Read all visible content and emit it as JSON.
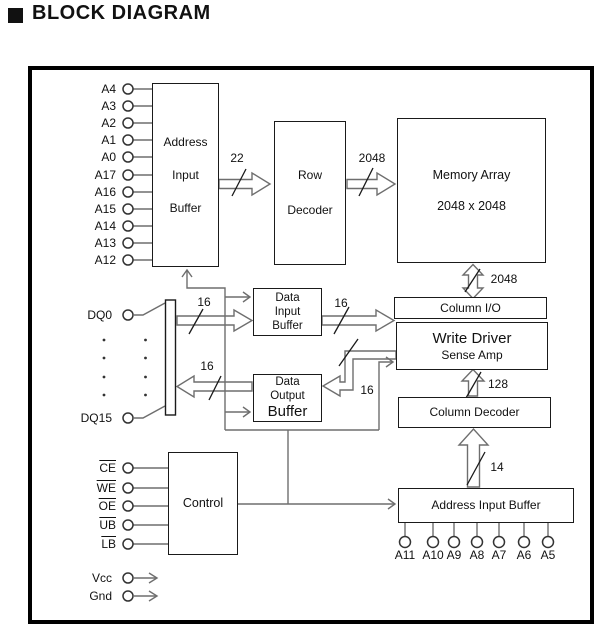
{
  "title": "BLOCK DIAGRAM",
  "blocks": {
    "address_input_buffer_top": {
      "line1": "Address",
      "line2": "Input",
      "line3": "Buffer"
    },
    "row_decoder": {
      "line1": "Row",
      "line2": "Decoder"
    },
    "memory_array": {
      "line1": "Memory Array",
      "line2": "2048 x 2048"
    },
    "column_io": {
      "label": "Column I/O"
    },
    "write_driver": {
      "line1": "Write Driver",
      "line2": "Sense Amp"
    },
    "column_decoder": {
      "label": "Column Decoder"
    },
    "data_input_buffer": {
      "line1": "Data",
      "line2": "Input",
      "line3": "Buffer"
    },
    "data_output_buffer": {
      "line1": "Data",
      "line2": "Output",
      "line3": "Buffer"
    },
    "control": {
      "label": "Control"
    },
    "address_input_buffer_bottom": {
      "label": "Address Input Buffer"
    }
  },
  "buses": {
    "addr_to_row_decoder": "22",
    "row_decoder_to_memory": "2048",
    "memory_to_column_io": "2048",
    "dq_to_data_input": "16",
    "data_input_to_write_driver": "16",
    "write_driver_to_data_output": "16",
    "data_output_to_dq": "16",
    "column_decoder_to_write_driver": "128",
    "addr_buffer_to_column_decoder": "14"
  },
  "pins": {
    "address_left": [
      "A4",
      "A3",
      "A2",
      "A1",
      "A0",
      "A17",
      "A16",
      "A15",
      "A14",
      "A13",
      "A12"
    ],
    "dq_first": "DQ0",
    "dq_last": "DQ15",
    "control": [
      "CE",
      "WE",
      "OE",
      "UB",
      "LB"
    ],
    "power": [
      "Vcc",
      "Gnd"
    ],
    "address_bottom": [
      "A11",
      "A10",
      "A9",
      "A8",
      "A7",
      "A6",
      "A5"
    ]
  },
  "colors": {
    "line": "#6e6e6e",
    "box_border": "#1a1a1a",
    "text": "#111111",
    "frame": "#000000"
  }
}
